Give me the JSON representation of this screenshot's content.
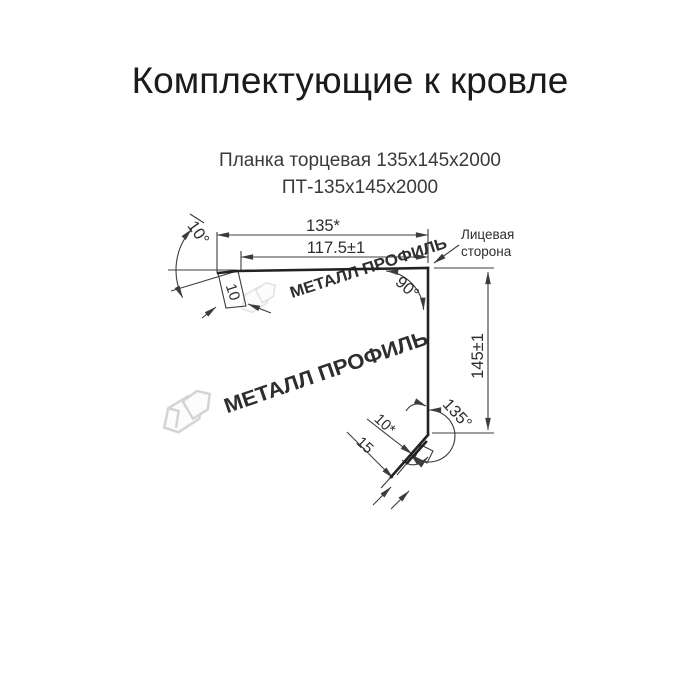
{
  "page_title": "Комплектующие к кровле",
  "product": {
    "name": "Планка торцевая 135х145х2000",
    "code": "ПТ-135х145х2000"
  },
  "drawing": {
    "dimensions": {
      "top_width": "135*",
      "top_inner_width": "117.5±1",
      "left_bend_angle": "10°",
      "left_flange_length": "10",
      "right_corner_angle": "90°",
      "side_height": "145±1",
      "bottom_bend_angle": "135°",
      "hem_length": "10*",
      "bottom_flange_length": "15"
    },
    "annotations": {
      "face_side_line1": "Лицевая",
      "face_side_line2": "сторона"
    }
  },
  "watermark": {
    "brand": "МЕТАЛЛ ПРОФИЛЬ"
  },
  "colors": {
    "thin_line": "#3c3c3c",
    "profile_line": "#222222",
    "text": "#2e2e2e",
    "watermark": "#d7d7d7",
    "background": "#ffffff"
  }
}
